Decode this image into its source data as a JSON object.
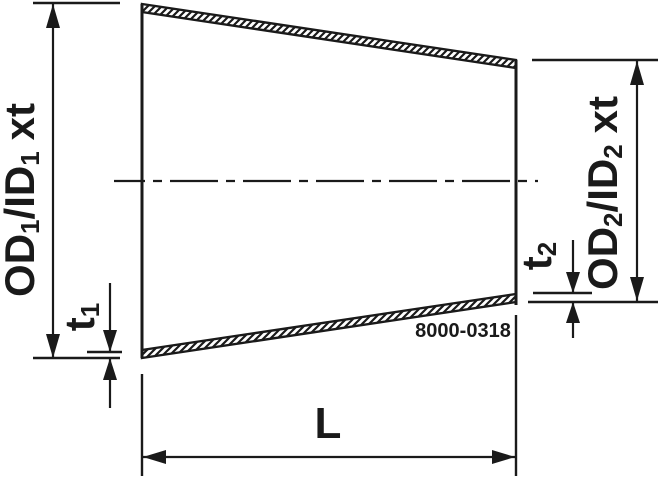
{
  "page": {
    "background_color": "#ffffff",
    "line_color": "#1a1a1a"
  },
  "labels": {
    "od1": {
      "part1": "OD",
      "sub1": "1",
      "part2": "/ID",
      "sub2": "1",
      "suffix": "xt"
    },
    "od2": {
      "part1": "OD",
      "sub1": "2",
      "part2": "/ID",
      "sub2": "2",
      "suffix": "xt"
    },
    "t1": {
      "part1": "t",
      "sub1": "1"
    },
    "t2": {
      "part1": "t",
      "sub1": "2"
    },
    "length": "L",
    "drawing_number": "8000-0318"
  }
}
